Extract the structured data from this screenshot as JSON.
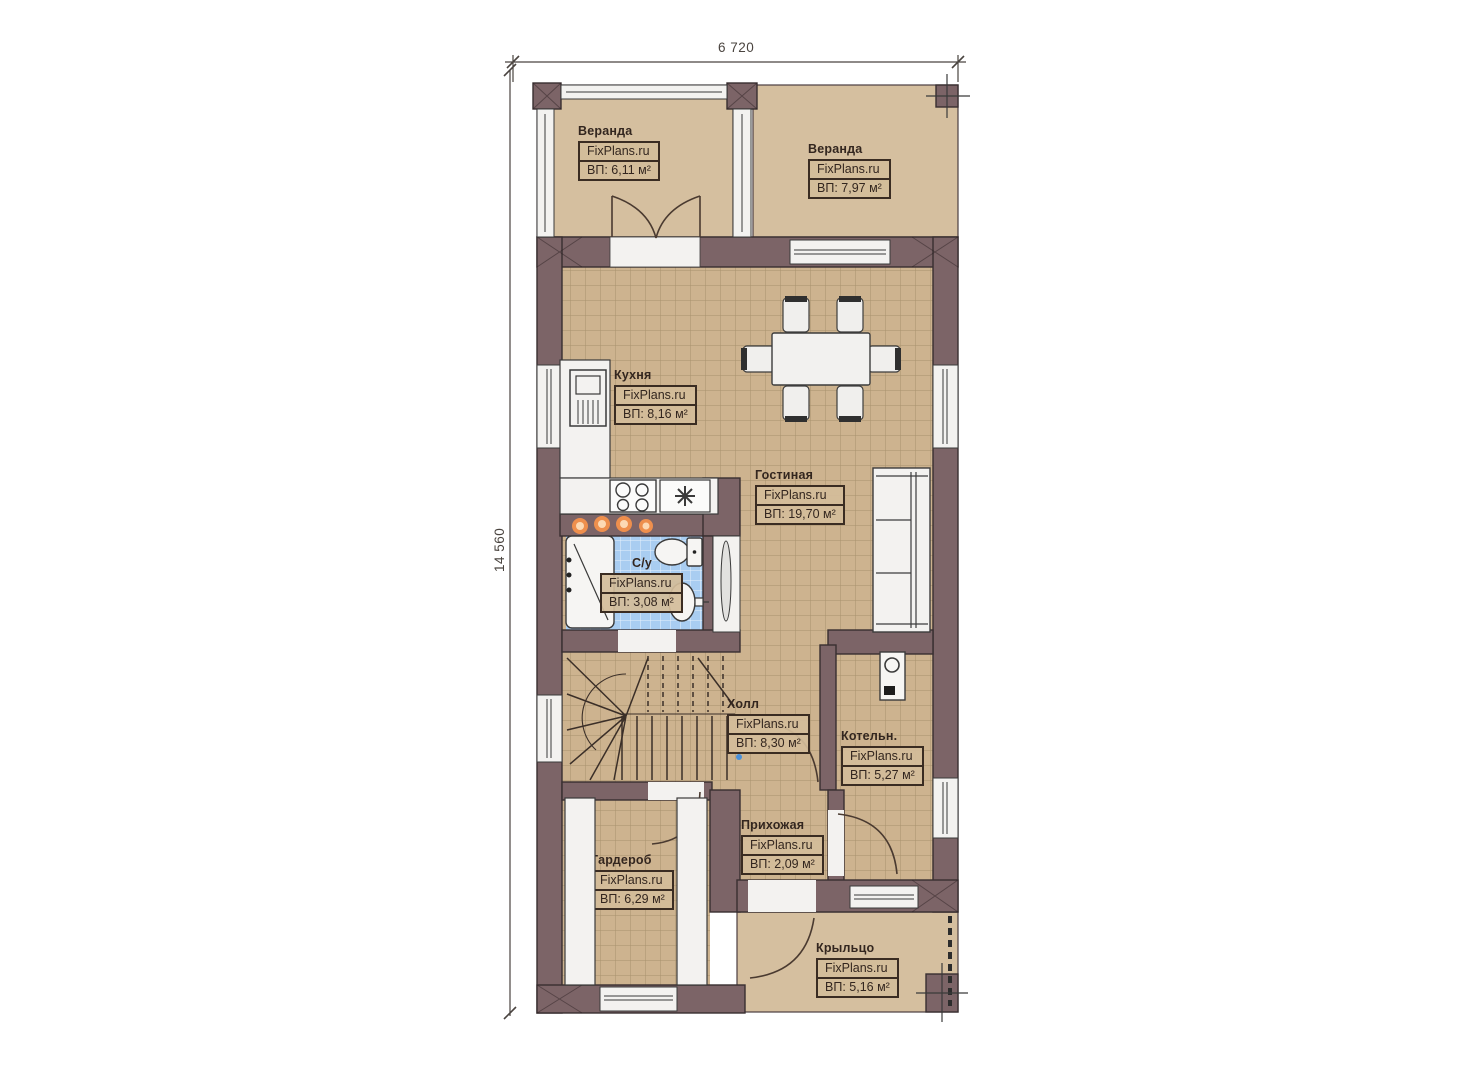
{
  "dimensions": {
    "width_label": "6 720",
    "height_label": "14 560"
  },
  "rooms": {
    "veranda_left": {
      "name": "Веранда",
      "brand": "FixPlans.ru",
      "area": "ВП: 6,11 м²"
    },
    "veranda_right": {
      "name": "Веранда",
      "brand": "FixPlans.ru",
      "area": "ВП: 7,97 м²"
    },
    "kitchen": {
      "name": "Кухня",
      "brand": "FixPlans.ru",
      "area": "ВП: 8,16 м²"
    },
    "living": {
      "name": "Гостиная",
      "brand": "FixPlans.ru",
      "area": "ВП: 19,70 м²"
    },
    "bathroom": {
      "name": "С/у",
      "brand": "FixPlans.ru",
      "area": "ВП: 3,08 м²"
    },
    "hall": {
      "name": "Холл",
      "brand": "FixPlans.ru",
      "area": "ВП: 8,30 м²"
    },
    "boiler": {
      "name": "Котельн.",
      "brand": "FixPlans.ru",
      "area": "ВП: 5,27 м²"
    },
    "entry": {
      "name": "Прихожая",
      "brand": "FixPlans.ru",
      "area": "ВП: 2,09 м²"
    },
    "wardrobe": {
      "name": "Гардероб",
      "brand": "FixPlans.ru",
      "area": "ВП: 6,29 м²"
    },
    "porch": {
      "name": "Крыльцо",
      "brand": "FixPlans.ru",
      "area": "ВП: 5,16 м²"
    }
  },
  "colors": {
    "wall": "#7c6467",
    "wall_outline": "#392f31",
    "veranda_floor": "#d5bf9f",
    "tile_floor": "#cdb38f",
    "tile_line": "#a8916c",
    "bath_tile": "#a9cdf1",
    "fixture_white": "#f3f2f0",
    "light_accent": "#ee8f4d",
    "label_ink": "#33261f"
  }
}
